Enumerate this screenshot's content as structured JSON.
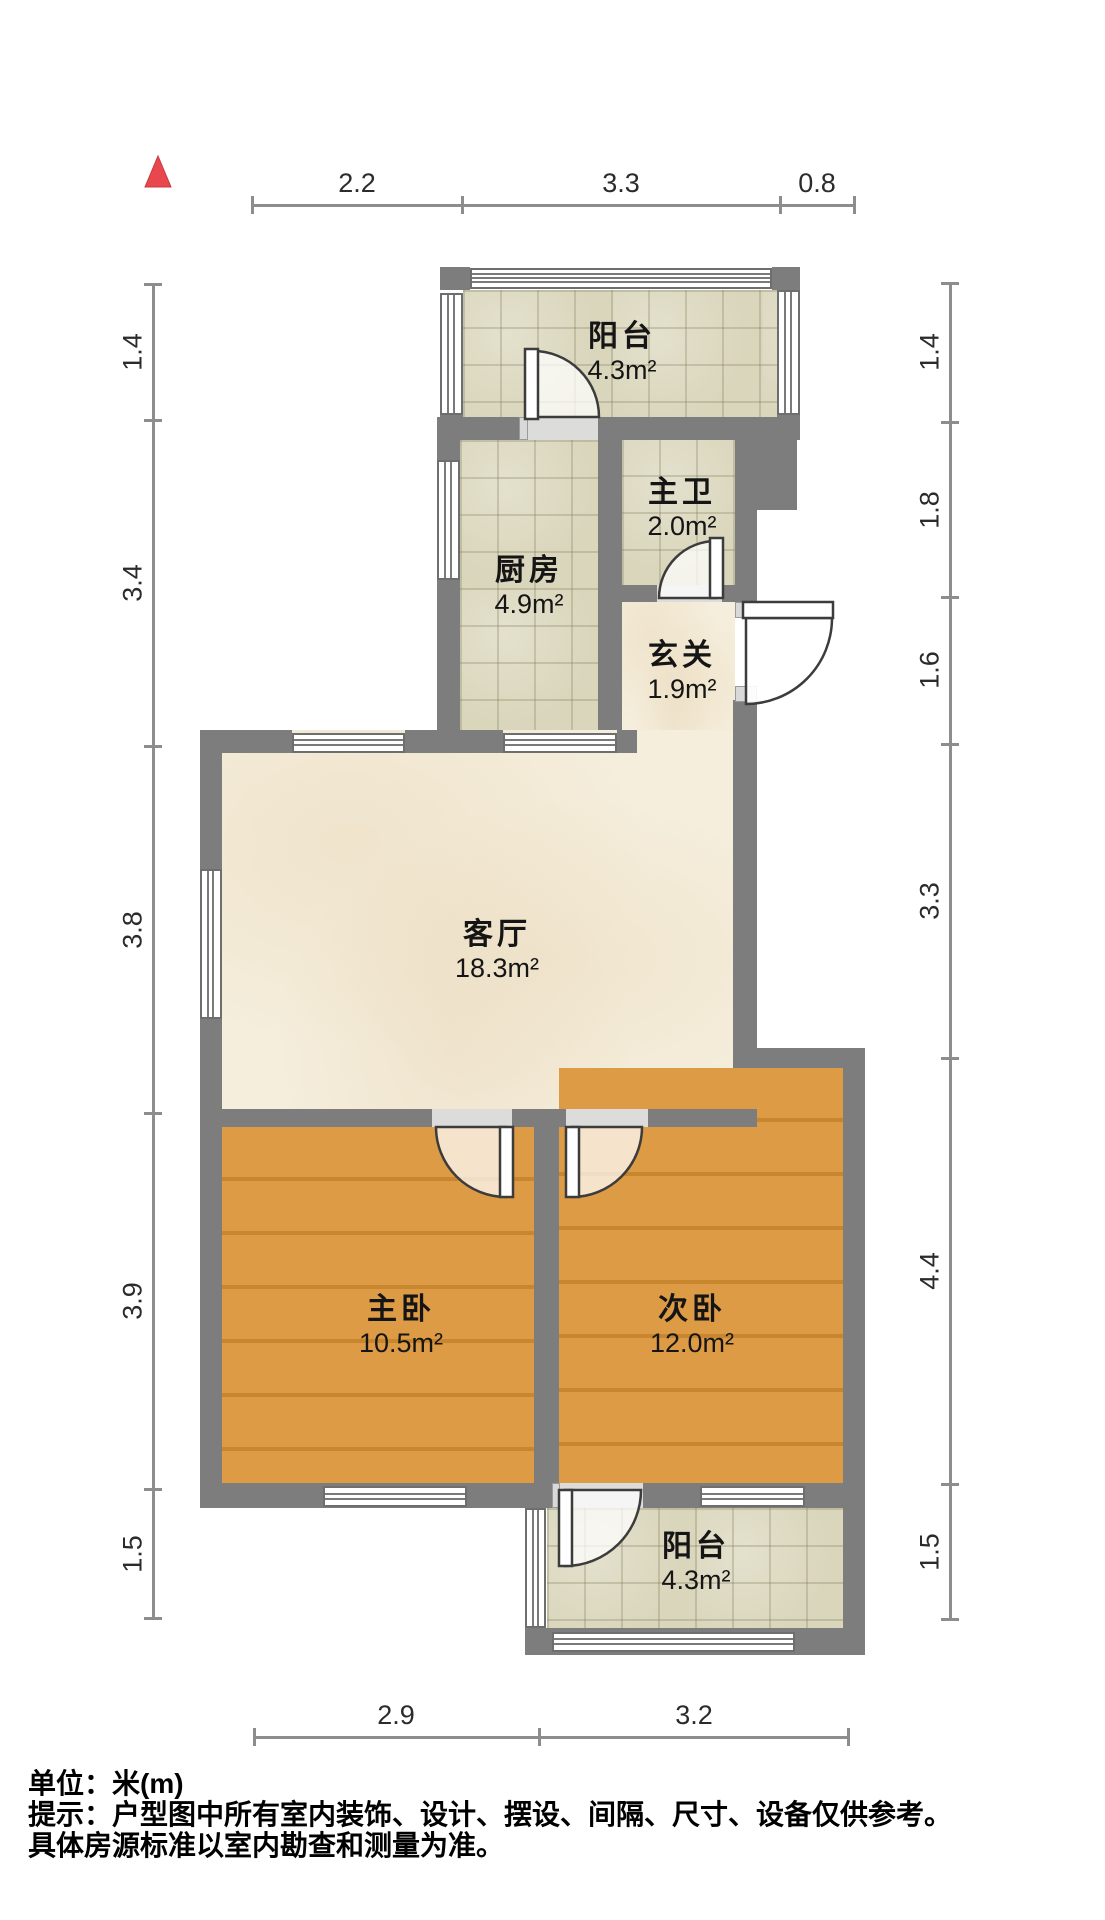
{
  "floorplan": {
    "rooms": [
      {
        "name": "阳台",
        "area": "4.3m²"
      },
      {
        "name": "厨房",
        "area": "4.9m²"
      },
      {
        "name": "主卫",
        "area": "2.0m²"
      },
      {
        "name": "玄关",
        "area": "1.9m²"
      },
      {
        "name": "客厅",
        "area": "18.3m²"
      },
      {
        "name": "主卧",
        "area": "10.5m²"
      },
      {
        "name": "次卧",
        "area": "12.0m²"
      },
      {
        "name": "阳台",
        "area": "4.3m²"
      }
    ],
    "dimensions_m": {
      "top": [
        "2.2",
        "3.3",
        "0.8"
      ],
      "left": [
        "1.4",
        "3.4",
        "3.8",
        "3.9",
        "1.5"
      ],
      "right": [
        "1.4",
        "1.8",
        "1.6",
        "3.3",
        "4.4",
        "1.5"
      ],
      "bottom": [
        "2.9",
        "3.2"
      ]
    },
    "footer": {
      "unit_line": "单位：米(m)",
      "note_line1": "提示：户型图中所有室内装饰、设计、摆设、间隔、尺寸、设备仅供参考。",
      "note_line2": "具体房源标准以室内勘查和测量为准。"
    },
    "colors": {
      "wall": "#7d7d7d",
      "tile_floor": "#dad6bc",
      "marble_floor": "#f5eedc",
      "wood_floor": "#d7933c",
      "north_arrow": "#e8484d",
      "dim_line": "#8d8d8d"
    }
  }
}
